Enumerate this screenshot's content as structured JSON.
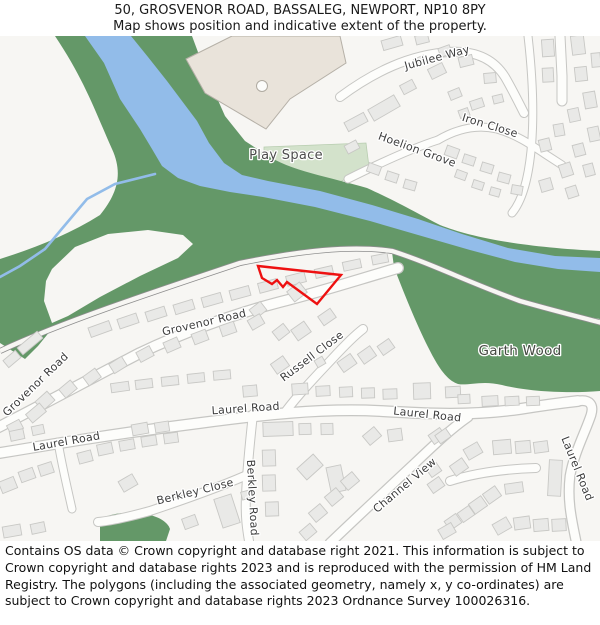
{
  "header": {
    "title": "50, GROSVENOR ROAD, BASSALEG, NEWPORT, NP10 8PY",
    "subtitle": "Map shows position and indicative extent of the property."
  },
  "map": {
    "labels": [
      {
        "id": "jubilee-way",
        "text": "Jubilee Way"
      },
      {
        "id": "iron-close",
        "text": "Iron Close"
      },
      {
        "id": "hoelion-grove",
        "text": "Hoelion Grove"
      },
      {
        "id": "play-space",
        "text": "Play Space"
      },
      {
        "id": "grovenor-road-upper",
        "text": "Grovenor Road"
      },
      {
        "id": "grovenor-road-lower",
        "text": "Grovenor Road"
      },
      {
        "id": "russell-close",
        "text": "Russell Close"
      },
      {
        "id": "garth-wood",
        "text": "Garth Wood"
      },
      {
        "id": "laurel-road-left",
        "text": "Laurel Road"
      },
      {
        "id": "laurel-road-center",
        "text": "Laurel Road"
      },
      {
        "id": "laurel-road-right",
        "text": "Laurel Road"
      },
      {
        "id": "laurel-road-vertical",
        "text": "Laurel Road"
      },
      {
        "id": "berkley-close",
        "text": "Berkley Close"
      },
      {
        "id": "berkley-road",
        "text": "Berkley Road"
      },
      {
        "id": "channel-view",
        "text": "Channel View"
      }
    ],
    "colors": {
      "map_background": "#f7f6f3",
      "woodland": "#649868",
      "water": "#92bce9",
      "play_space": "#d3e2cb",
      "road_fill": "#fdfdfb",
      "road_casing": "#c6c6c3",
      "building_fill": "#e9e9e7",
      "building_stroke": "#c8c8c5",
      "large_building_fill": "#e9e3da",
      "large_building_stroke": "#b5b0a7",
      "railway": "#8d8d8d",
      "property_outline": "#ee1111",
      "label_text": "#3c3c3c"
    }
  },
  "footer": {
    "copyright": "Contains OS data © Crown copyright and database right 2021. This information is subject to Crown copyright and database rights 2023 and is reproduced with the permission of HM Land Registry. The polygons (including the associated geometry, namely x, y co-ordinates) are subject to Crown copyright and database rights 2023 Ordnance Survey 100026316."
  }
}
